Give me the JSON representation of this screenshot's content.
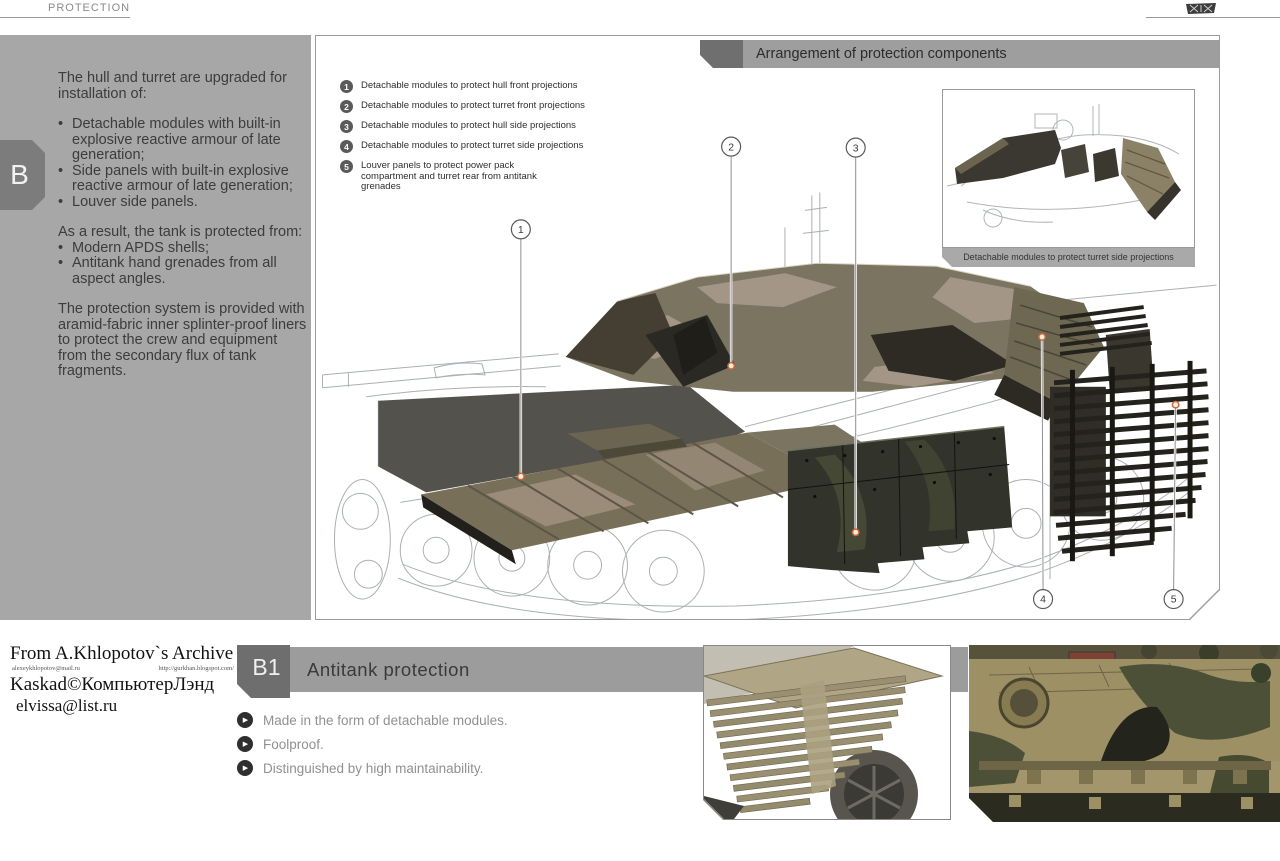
{
  "page": {
    "top_label": "PROTECTION"
  },
  "sidebar": {
    "tab_label": "B",
    "intro1": "The hull and turret are upgraded for installation of:",
    "bullets1": [
      "Detachable modules with built-in explosive reactive armour of late generation;",
      "Side panels with built-in explosive reactive armour of late generation;",
      "Louver side panels."
    ],
    "intro2": "As a result, the tank is protected from:",
    "bullets2": [
      "Modern APDS shells;",
      "Antitank hand grenades from all aspect angles."
    ],
    "para3": "The protection system is provided with aramid-fabric inner splinter-proof liners to protect the crew and equipment from the secondary flux of tank fragments."
  },
  "diagram": {
    "title": "Arrangement of protection components",
    "legend": [
      {
        "num": "1",
        "text": "Detachable modules to protect hull front projections"
      },
      {
        "num": "2",
        "text": "Detachable modules to protect turret front projections"
      },
      {
        "num": "3",
        "text": "Detachable modules to protect hull side projections"
      },
      {
        "num": "4",
        "text": "Detachable modules to protect turret side projections"
      },
      {
        "num": "5",
        "text": "Louver panels to protect power pack compartment and turret rear from antitank grenades"
      }
    ],
    "callouts": [
      {
        "num": "1"
      },
      {
        "num": "2"
      },
      {
        "num": "3"
      },
      {
        "num": "4"
      },
      {
        "num": "5"
      }
    ],
    "inset_caption": "Detachable modules to protect turret side projections"
  },
  "watermark": {
    "line1": "From A.Khlopotov`s Archive",
    "small_left": "alexeykhlopotov@mail.ru",
    "small_right": "http://gurkhan.blogspot.com/",
    "line2": "Kaskad©КомпьютерЛэнд",
    "line3": "elvissa@list.ru"
  },
  "section_b1": {
    "tab_label": "B1",
    "title": "Antitank protection",
    "bullets": [
      "Made in the form of detachable modules.",
      "Foolproof.",
      "Distinguished by high maintainability."
    ]
  },
  "icons": {
    "bullet_dot": "•",
    "bullet_play": "▶"
  },
  "colors": {
    "sidebar_gray": "#a7a7a7",
    "tab_dark_gray": "#6f6f6f",
    "bar_gray": "#9e9e9e",
    "module_olive": "#7b7460",
    "skirt_dark": "#32332b",
    "callout_accent": "#c96a40"
  }
}
